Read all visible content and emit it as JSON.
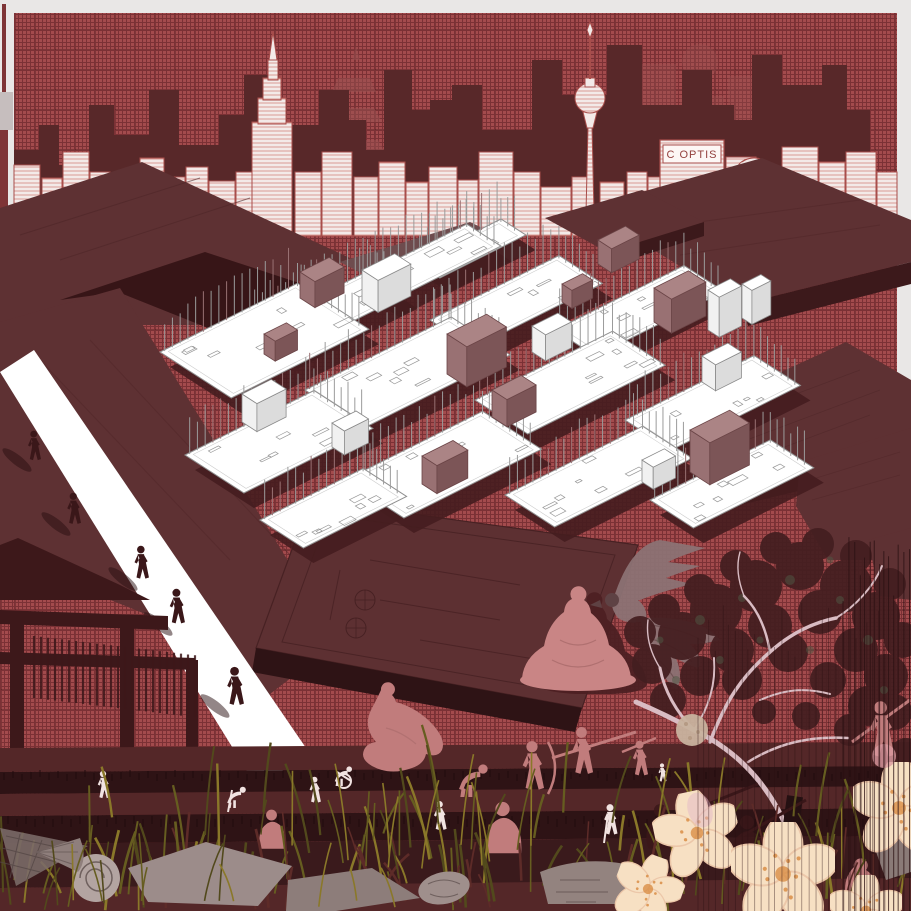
{
  "artwork": {
    "sign_text": "C OPTIS"
  },
  "colors": {
    "frame": "#e9e7e6",
    "frame_shade": "#c6bebe",
    "accent_red": "#7e3436",
    "hatch_base": "#a34b4d",
    "hatch_line": "#7b3135",
    "silhouette": "#582829",
    "faint": "#9a5251",
    "paper": "#f3eae8",
    "sketch": "#a84e4b",
    "sketch_light": "#d79089",
    "roof_top": "#5e3133",
    "roof_side": "#3c191b",
    "roof_line": "#4f2628",
    "roof_gap": "#371517",
    "roof_mid": "#6e4c4e",
    "plate": "#ffffff",
    "plate_line": "#8f8f8f",
    "plate_shadow": "#451d1f",
    "box_mauve_top": "#ab8485",
    "box_mauve": "#997173",
    "box_mauve_dark": "#7c5557",
    "box_line": "#6b4547",
    "white_box_side": "#dcdcdc",
    "dark_plate": "#5d3032",
    "dark_plate_line": "#472123",
    "walkway": "#ffffff",
    "figure_dark": "#3a1719",
    "figure_pink": "#c17c7c",
    "figure_white": "#f1e3e1",
    "statue_pink": "#c98585",
    "statue_shadow": "#4d2023",
    "bird": "#8c7274",
    "bird_dark": "#5f4345",
    "soil_dark": "#3a1a1c",
    "soil_mid": "#542728",
    "soil_deep": "#2e1315",
    "grass1": "#8a7829",
    "grass2": "#665d20",
    "grass3": "#52491c",
    "grass4": "#5d2b28",
    "debris": "#9c8c8a",
    "debris_light": "#b3a4a1",
    "debris_line": "#6f605e",
    "branch": "#d9bcc3",
    "foliage": "#441e20",
    "foliage_green": "#4e5a45",
    "blossom": "#f7e0c3",
    "blossom_edge": "#ecc7a9",
    "blossom_dot": "#d8893f",
    "blossom_pink": "#e3b7c7",
    "string": "#2a1012",
    "torii": "#3d181a"
  }
}
